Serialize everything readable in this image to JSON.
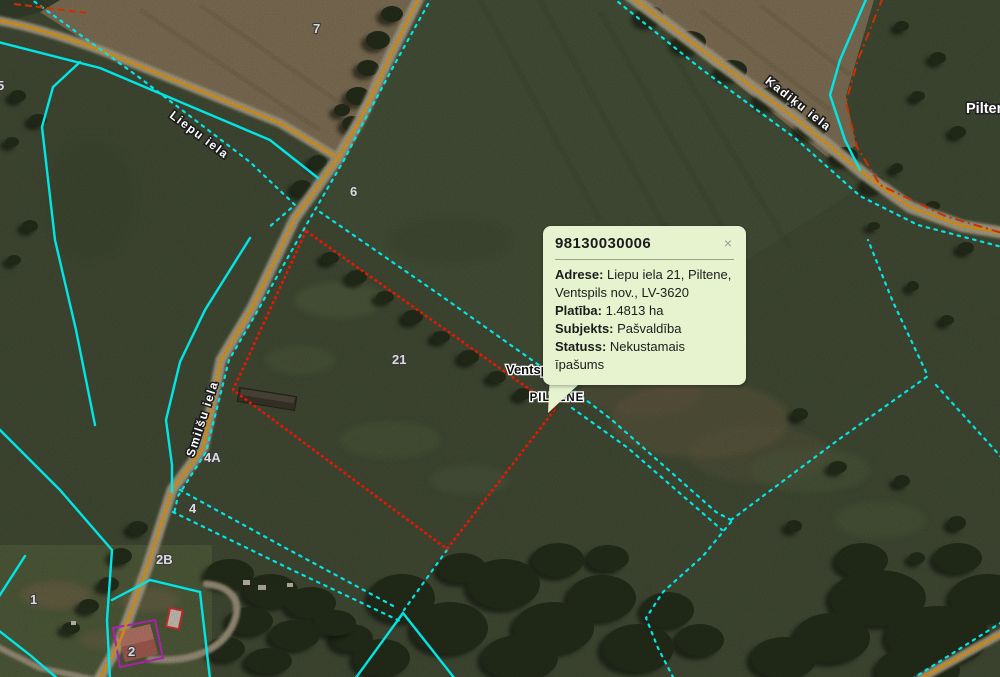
{
  "map": {
    "labels": {
      "town": "Piltene",
      "place": "PILTENE",
      "municipality": "Ventspils nov."
    },
    "streets": [
      {
        "name": "Liepu iela"
      },
      {
        "name": "Smilšu iela"
      },
      {
        "name": "Kadiķu iela"
      }
    ],
    "parcels": [
      {
        "n": "7"
      },
      {
        "n": "6"
      },
      {
        "n": "21"
      },
      {
        "n": "5"
      },
      {
        "n": "4A"
      },
      {
        "n": "4"
      },
      {
        "n": "2B"
      },
      {
        "n": "2"
      },
      {
        "n": "1"
      }
    ]
  },
  "popup": {
    "title": "98130030006",
    "close_label": "×",
    "rows": [
      {
        "label": "Adrese:",
        "value": "Liepu iela 21, Piltene, Ventspils nov., LV-3620"
      },
      {
        "label": "Platība:",
        "value": "1.4813 ha"
      },
      {
        "label": "Subjekts:",
        "value": "Pašvaldība"
      },
      {
        "label": "Statuss:",
        "value": "Nekustamais īpašums"
      }
    ]
  },
  "colors": {
    "boundary": "#00e6e6",
    "parcel": "#ee1400",
    "road": "#f2a71b",
    "roadmark": "#cc3000",
    "popup": "#e7f3cf",
    "building": "#d02ad0"
  }
}
